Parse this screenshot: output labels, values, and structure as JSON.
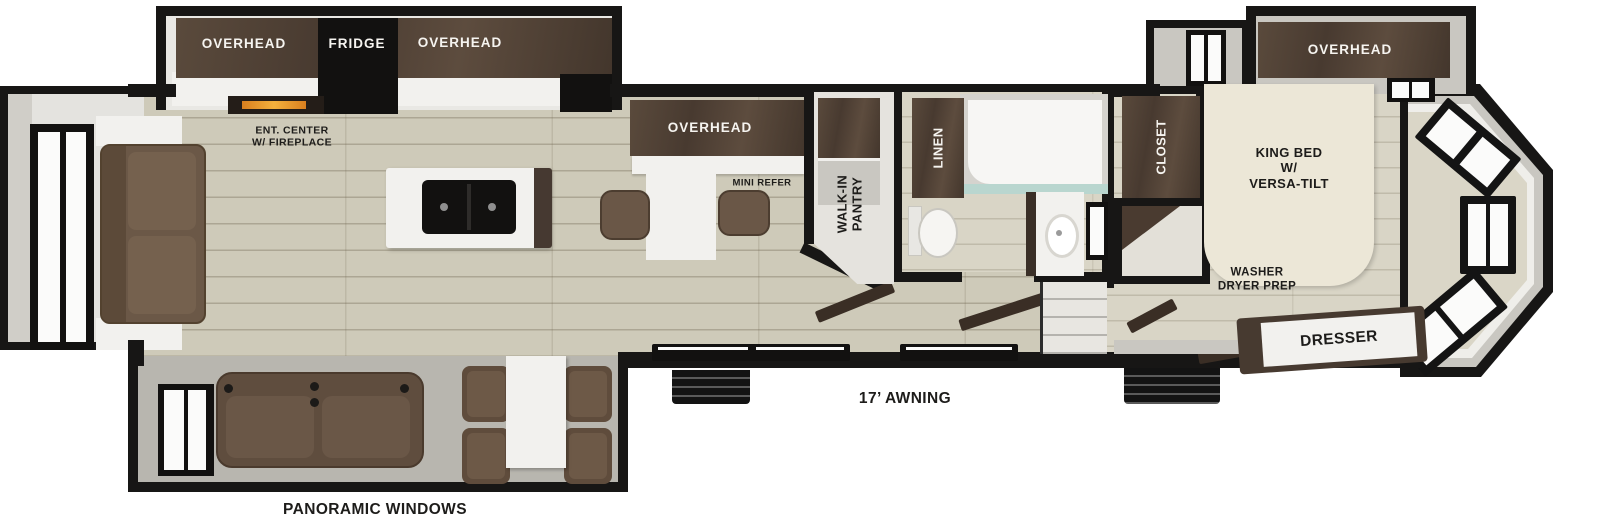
{
  "floorplan": {
    "labels": {
      "overhead_left": "OVERHEAD",
      "fridge": "FRIDGE",
      "overhead_right": "OVERHEAD",
      "ent_center": "ENT. CENTER\nW/ FIREPLACE",
      "overhead_mid": "OVERHEAD",
      "mini_refer": "MINI REFER",
      "walk_in_pantry": "WALK-IN\nPANTRY",
      "linen": "LINEN",
      "closet": "CLOSET",
      "king_bed": "KING BED\nW/\nVERSA-TILT",
      "overhead_bedroom": "OVERHEAD",
      "washer_dryer_prep": "WASHER\nDRYER PREP",
      "dresser": "DRESSER",
      "awning": "17’ AWNING",
      "panoramic_windows": "PANORAMIC WINDOWS"
    },
    "colors": {
      "wall_black": "#171615",
      "cabinet_dark_brown": "#4b3d33",
      "floor_main": "#cecab9",
      "floor_bedroom": "#d9d5c6",
      "sofa_brown": "#6b5847",
      "seat_brown": "#5f4d3e",
      "bed_cream": "#ece7d7",
      "counter_white": "#f2f1ee",
      "shower_glass_teal": "#b9d6cf",
      "fireplace_glow": "#f3b13d"
    }
  }
}
